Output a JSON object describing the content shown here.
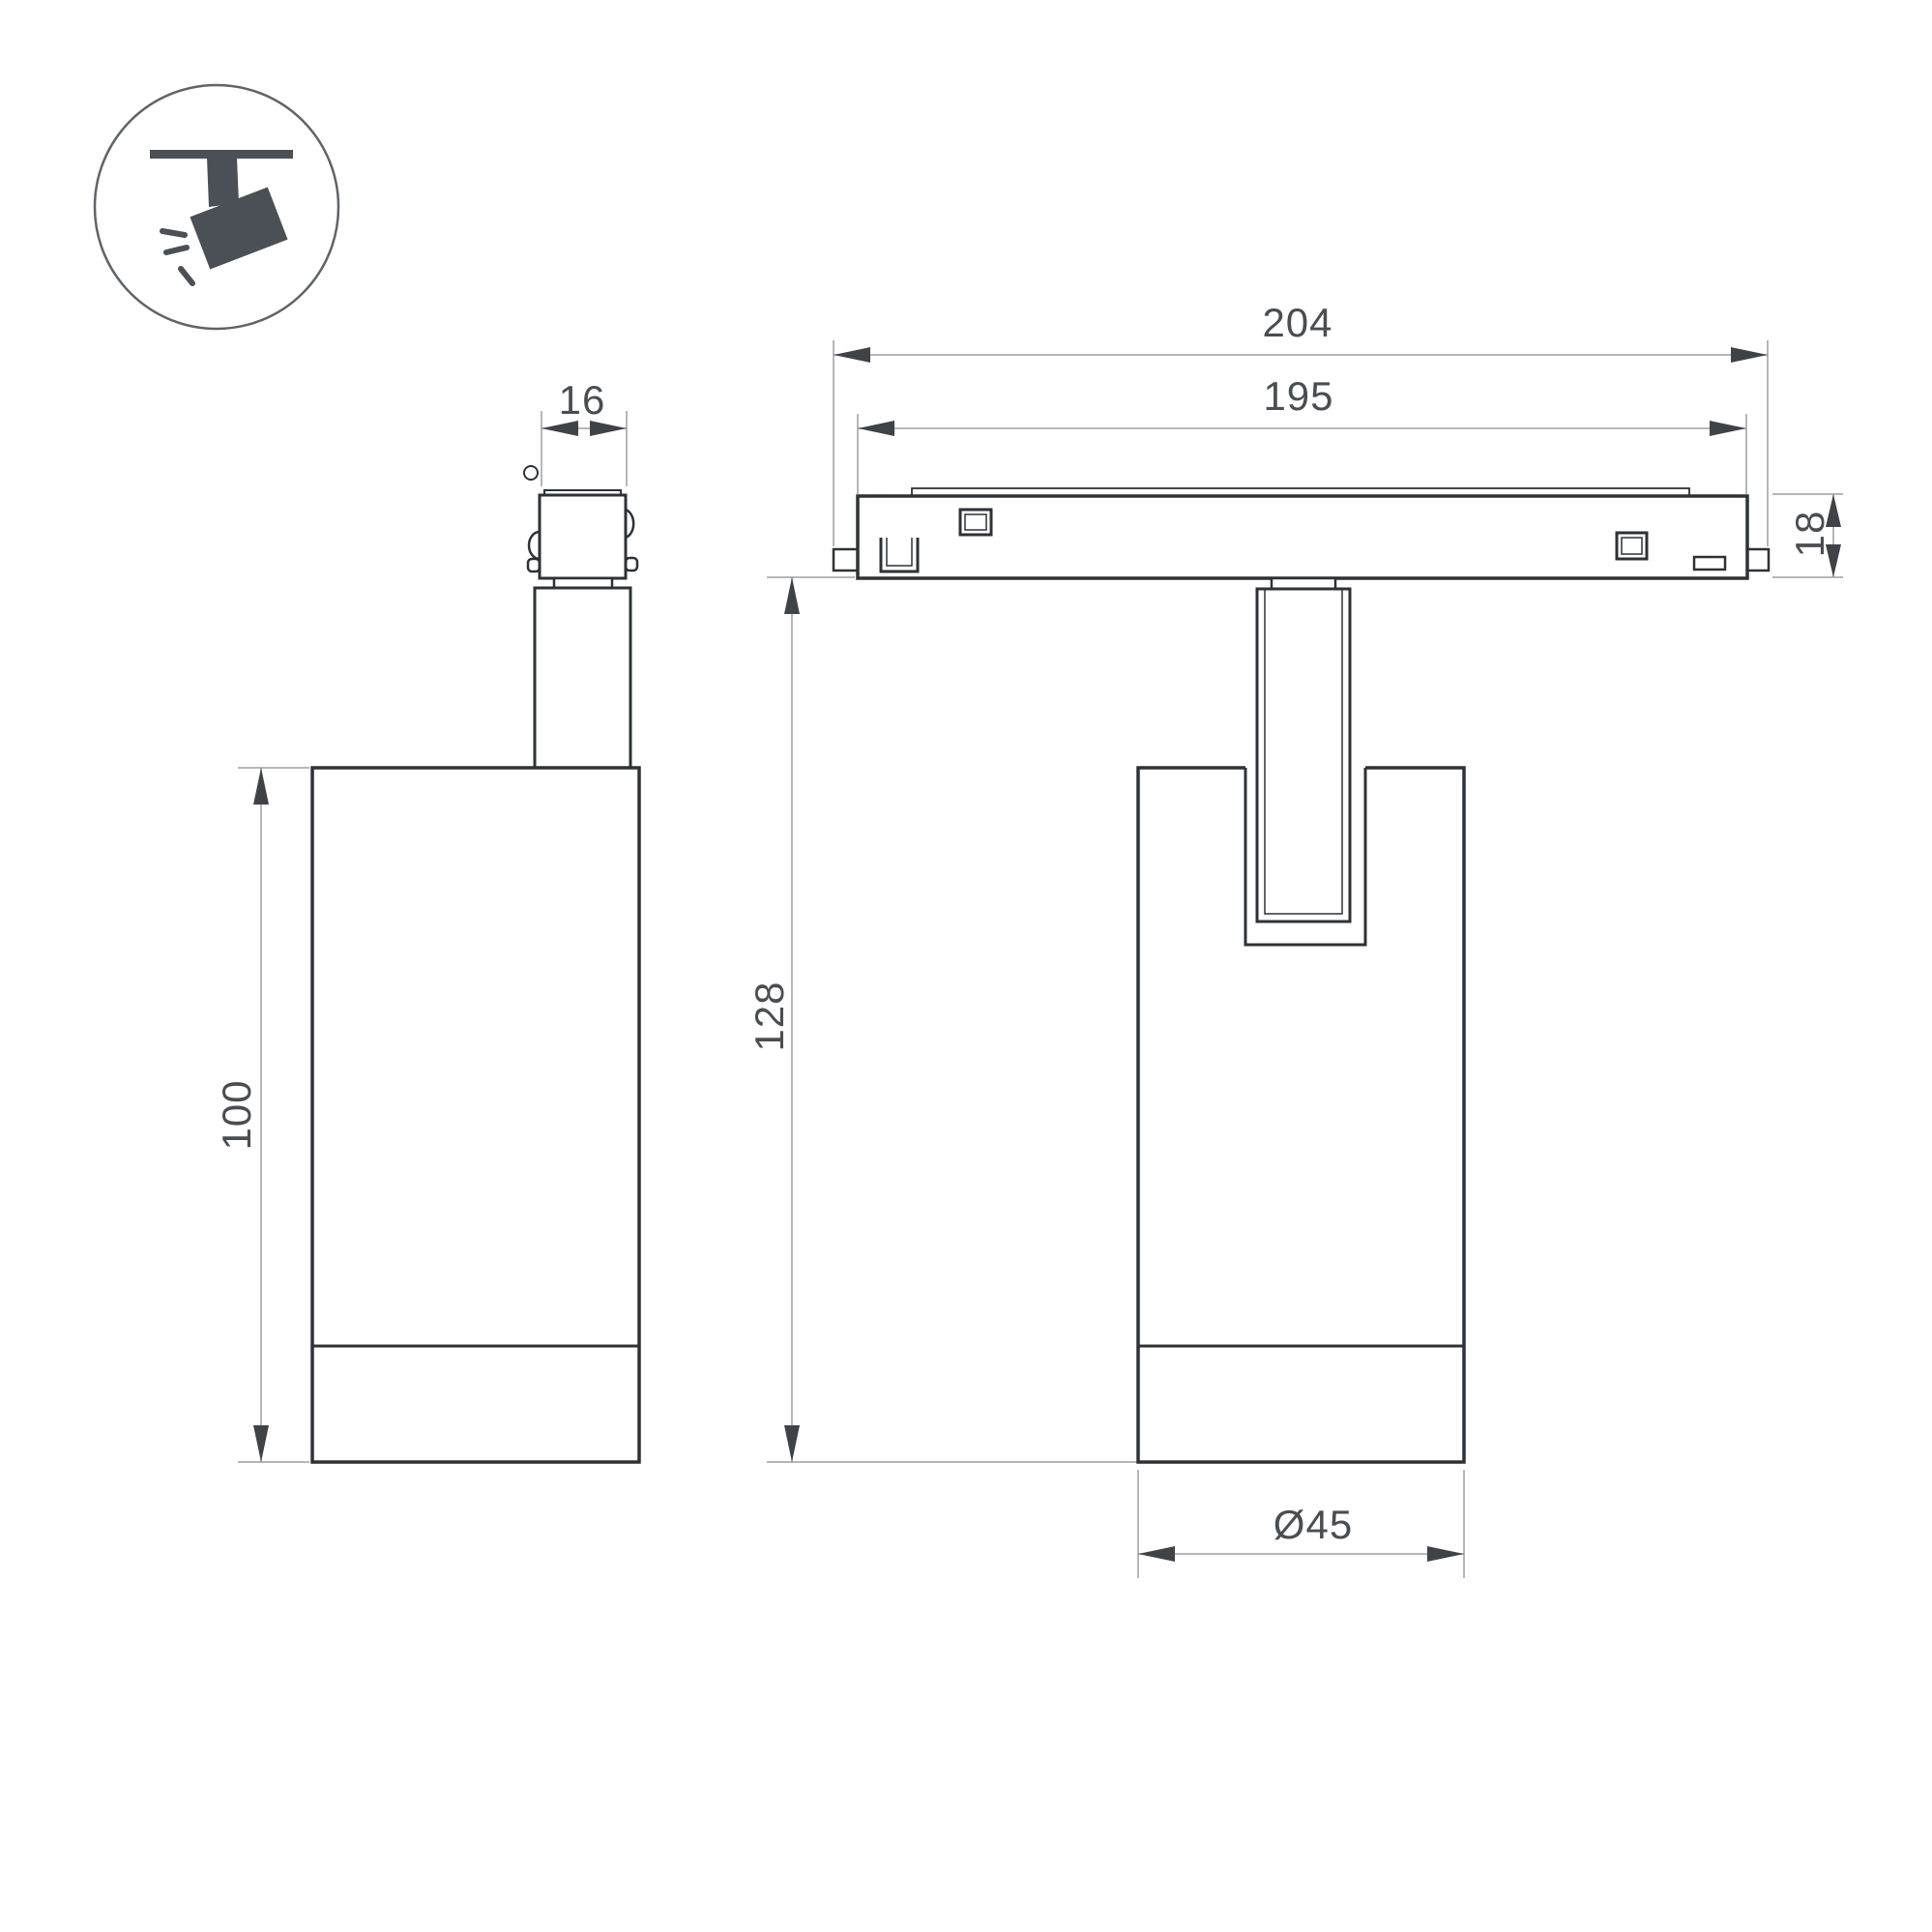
{
  "drawing": {
    "type": "luminaire-dimension-drawing",
    "background": "#ffffff",
    "colors": {
      "outline": "#2e3236",
      "thin_line": "#9aa0a4",
      "arrow": "#3f4347",
      "text": "#4a4e52",
      "icon": "#4a5055"
    },
    "icon": {
      "name": "ceiling-track-spotlight-pictogram"
    },
    "views": {
      "side_view": "spotlight side view with track adapter",
      "front_view": "spotlight front view mounted on magnetic track"
    },
    "dimensions": {
      "track_length": "204",
      "track_inner_length": "195",
      "track_height": "18",
      "adapter_width": "16",
      "body_height": "100",
      "overall_height": "128",
      "body_diameter": "Ø45"
    }
  }
}
